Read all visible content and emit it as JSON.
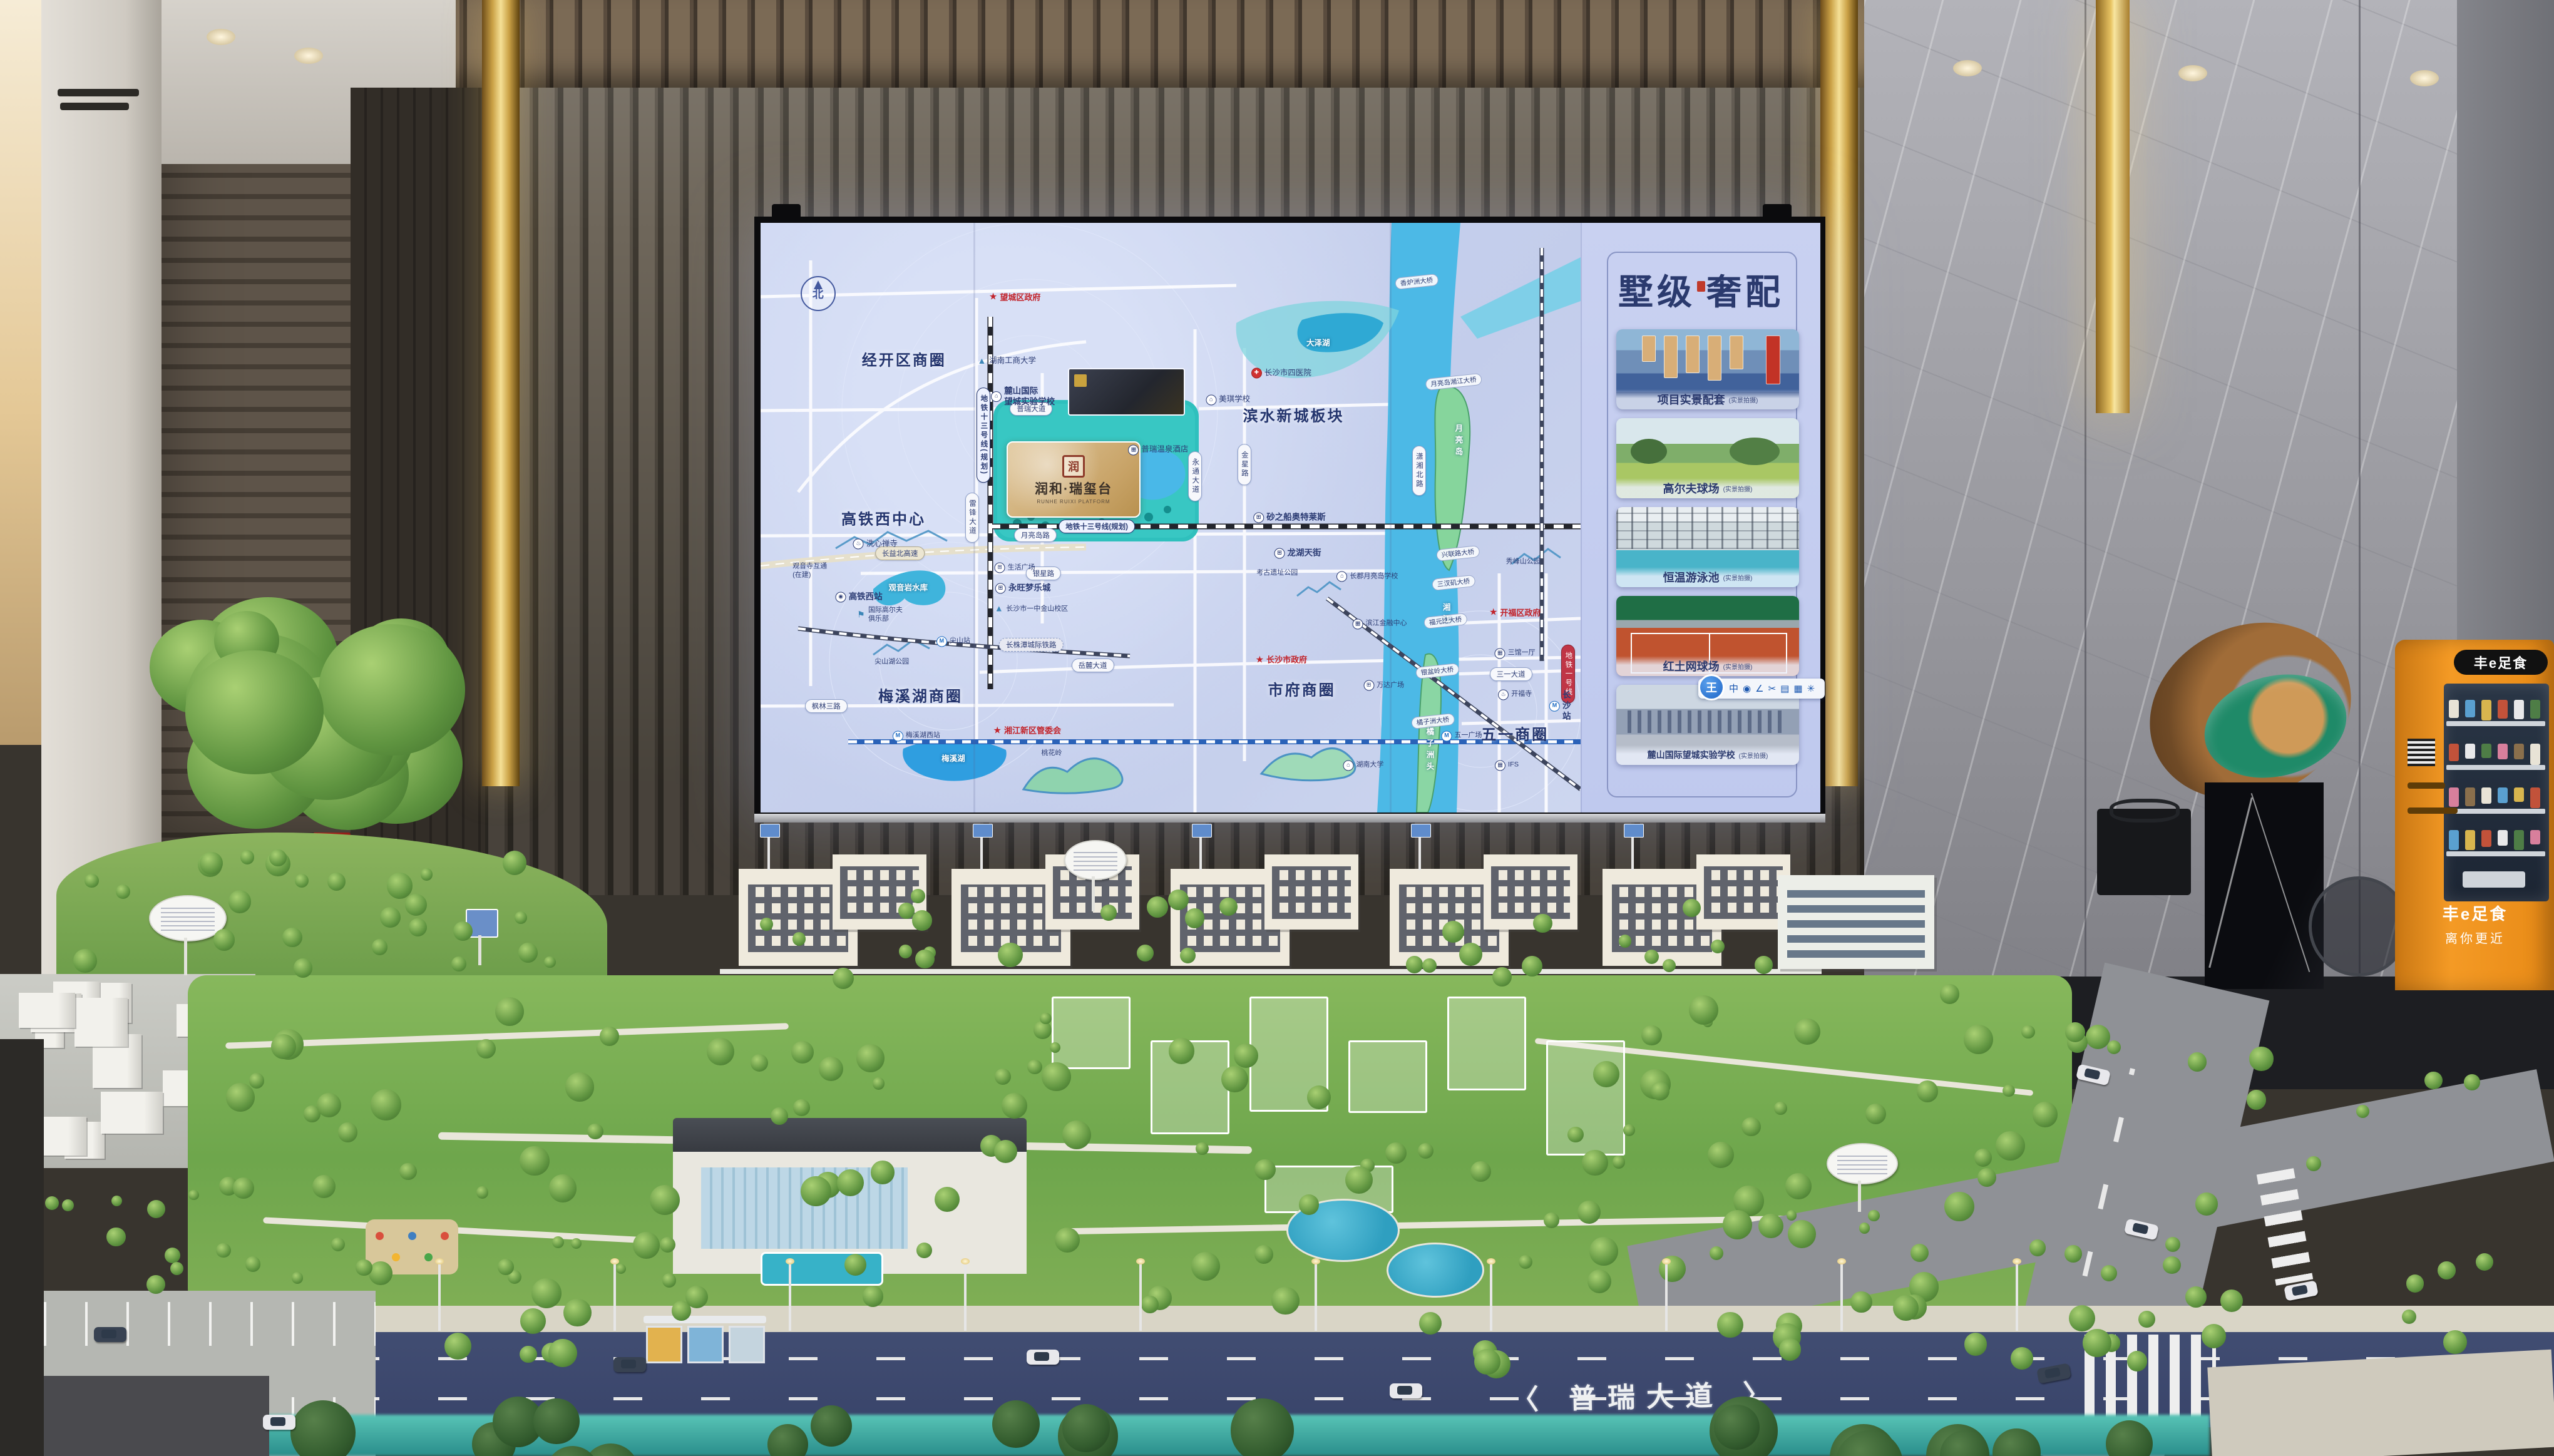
{
  "screen": {
    "map": {
      "compass": "北",
      "project": {
        "logo_char": "润",
        "name": "润和·瑞玺台",
        "name_en": "RUNHE RUIXI PLATFORM"
      },
      "area_labels": [
        {
          "text": "经开区商圈",
          "x": 17.5,
          "y": 23
        },
        {
          "text": "高铁西中心",
          "x": 15,
          "y": 50
        },
        {
          "text": "滨水新城板块",
          "x": 65,
          "y": 32.5
        },
        {
          "text": "梅溪湖商圈",
          "x": 19.5,
          "y": 80
        },
        {
          "text": "市府商圈",
          "x": 66,
          "y": 79
        },
        {
          "text": "五一商圈",
          "x": 92,
          "y": 86.5
        }
      ],
      "star_labels": [
        {
          "text": "望城区政府",
          "x": 31,
          "y": 12.5
        },
        {
          "text": "湘江新区管委会",
          "x": 32.5,
          "y": 86
        },
        {
          "text": "长沙市政府",
          "x": 63.5,
          "y": 74
        },
        {
          "text": "开福区政府",
          "x": 92,
          "y": 66
        }
      ],
      "road_labels": [
        {
          "text": "普瑞大道",
          "x": 33,
          "y": 31.5,
          "style": "road"
        },
        {
          "text": "月亮岛路",
          "x": 33.5,
          "y": 53,
          "style": "road"
        },
        {
          "text": "银星路",
          "x": 34.5,
          "y": 59.5,
          "style": "road"
        },
        {
          "text": "岳麓大道",
          "x": 40.5,
          "y": 75,
          "style": "road"
        },
        {
          "text": "枫林三路",
          "x": 8,
          "y": 82,
          "style": "road"
        },
        {
          "text": "三一大道",
          "x": 91.5,
          "y": 76.5,
          "style": "road"
        },
        {
          "text": "长益北高速",
          "x": 17,
          "y": 56,
          "style": "highway"
        },
        {
          "text": "长株潭城际铁路",
          "x": 33,
          "y": 71.5,
          "style": "rail"
        },
        {
          "text": "地铁十三号线(规划)",
          "x": 41,
          "y": 51.5,
          "style": "metro13"
        },
        {
          "text": "地铁十三号线(规划)",
          "x": 27.2,
          "y": 36,
          "style": "metro13",
          "vertical": true
        },
        {
          "text": "雷锋大道",
          "x": 25.8,
          "y": 50,
          "style": "road",
          "vertical": true
        },
        {
          "text": "永通大道",
          "x": 53,
          "y": 43,
          "style": "road",
          "vertical": true
        },
        {
          "text": "金星路",
          "x": 59,
          "y": 41,
          "style": "road",
          "vertical": true
        },
        {
          "text": "潇湘北路",
          "x": 80.3,
          "y": 42,
          "style": "road",
          "vertical": true
        },
        {
          "text": "地铁一号线",
          "x": 98.5,
          "y": 76.5,
          "style": "redline",
          "vertical": true
        }
      ],
      "bridge_labels": [
        {
          "text": "香炉洲大桥",
          "x": 80,
          "y": 10
        },
        {
          "text": "月亮岛湘江大桥",
          "x": 84.5,
          "y": 27
        },
        {
          "text": "兴联路大桥",
          "x": 85,
          "y": 56
        },
        {
          "text": "三汊矶大桥",
          "x": 84.5,
          "y": 61
        },
        {
          "text": "福元路大桥",
          "x": 83.5,
          "y": 67.5
        },
        {
          "text": "银盆岭大桥",
          "x": 82.5,
          "y": 76
        },
        {
          "text": "橘子洲大桥",
          "x": 82,
          "y": 84.5
        }
      ],
      "poi_labels": [
        {
          "text": "麓山国际\n望城实验学校",
          "x": 32,
          "y": 29.5,
          "icon": "school",
          "cls": "bold"
        },
        {
          "text": "湖南工商大学",
          "x": 30,
          "y": 23.5,
          "icon": "mountain"
        },
        {
          "text": "美琪学校",
          "x": 57,
          "y": 30,
          "icon": "school"
        },
        {
          "text": "普瑞温泉酒店",
          "x": 48.5,
          "y": 38.5,
          "icon": "building"
        },
        {
          "text": "长沙市四医院",
          "x": 63.5,
          "y": 25.5,
          "icon": "hospital"
        },
        {
          "text": "洗心禅寺",
          "x": 14,
          "y": 54.5,
          "icon": "temple"
        },
        {
          "text": "高铁西站",
          "x": 12,
          "y": 63.5,
          "icon": "train",
          "cls": "bold"
        },
        {
          "text": "观音岩水库",
          "x": 18,
          "y": 62,
          "cls": "white"
        },
        {
          "text": "观音寺互通\n(在建)",
          "x": 6,
          "y": 59,
          "cls": "small"
        },
        {
          "text": "国际高尔夫\n俱乐部",
          "x": 14.5,
          "y": 66.5,
          "icon": "golf",
          "cls": "small"
        },
        {
          "text": "尖山站",
          "x": 23.5,
          "y": 71,
          "icon": "metro",
          "cls": "small"
        },
        {
          "text": "尖山湖公园",
          "x": 16,
          "y": 74.5,
          "cls": "small"
        },
        {
          "text": "永旺梦乐城",
          "x": 32,
          "y": 62,
          "icon": "cart",
          "cls": "bold"
        },
        {
          "text": "生活广场",
          "x": 31,
          "y": 58.5,
          "icon": "cart",
          "cls": "small"
        },
        {
          "text": "长沙市一中金山校区",
          "x": 33,
          "y": 65.5,
          "icon": "mountain",
          "cls": "small"
        },
        {
          "text": "梅溪湖西站",
          "x": 19,
          "y": 87,
          "icon": "metro",
          "cls": "small"
        },
        {
          "text": "梅溪湖",
          "x": 23.5,
          "y": 91,
          "cls": "white"
        },
        {
          "text": "桃花岭",
          "x": 35.5,
          "y": 90,
          "cls": "small"
        },
        {
          "text": "砂之船奥特莱斯",
          "x": 64.5,
          "y": 50,
          "icon": "cart",
          "cls": "bold"
        },
        {
          "text": "龙湖天街",
          "x": 65.5,
          "y": 56,
          "icon": "cart",
          "cls": "bold"
        },
        {
          "text": "考古遗址公园",
          "x": 63,
          "y": 59.5,
          "cls": "small"
        },
        {
          "text": "长郡月亮岛学校",
          "x": 74,
          "y": 60,
          "icon": "school",
          "cls": "small"
        },
        {
          "text": "秀峰山公园",
          "x": 93,
          "y": 57.5,
          "cls": "small"
        },
        {
          "text": "滨江金融中心",
          "x": 75.5,
          "y": 68,
          "icon": "building",
          "cls": "small"
        },
        {
          "text": "万达广场",
          "x": 76,
          "y": 78.5,
          "icon": "cart",
          "cls": "small"
        },
        {
          "text": "湖南大学",
          "x": 73.5,
          "y": 92,
          "icon": "school",
          "cls": "small"
        },
        {
          "text": "三馆一厅",
          "x": 92,
          "y": 73,
          "icon": "building",
          "cls": "small"
        },
        {
          "text": "开福寺",
          "x": 92,
          "y": 80,
          "icon": "temple",
          "cls": "small"
        },
        {
          "text": "长沙站",
          "x": 97.5,
          "y": 82,
          "icon": "metro",
          "cls": "bold"
        },
        {
          "text": "五一广场",
          "x": 85.5,
          "y": 87,
          "icon": "metro",
          "cls": "small"
        },
        {
          "text": "IFS",
          "x": 91,
          "y": 92,
          "icon": "building",
          "cls": "small"
        },
        {
          "text": "大泽湖",
          "x": 68,
          "y": 20.5,
          "cls": "white"
        },
        {
          "text": "月亮岛",
          "x": 85,
          "y": 37,
          "cls": "white vert"
        },
        {
          "text": "湘江",
          "x": 83.5,
          "y": 66.5,
          "cls": "white vert"
        },
        {
          "text": "橘子洲头",
          "x": 81.5,
          "y": 89.5,
          "cls": "white vert"
        }
      ]
    },
    "panel": {
      "title_left": "墅级",
      "title_right": "奢配",
      "cards": [
        {
          "caption": "项目实景配套",
          "sub": "(实景拍摄)",
          "kind": "aerial"
        },
        {
          "caption": "高尔夫球场",
          "sub": "(实景拍摄)",
          "kind": "golf"
        },
        {
          "caption": "恒温游泳池",
          "sub": "(实景拍摄)",
          "kind": "pool"
        },
        {
          "caption": "红土网球场",
          "sub": "(实景拍摄)",
          "kind": "tennis"
        },
        {
          "caption": "麓山国际望城实验学校",
          "sub": "(实景拍摄)",
          "kind": "school"
        }
      ]
    },
    "toolbar": {
      "logo": "王",
      "icons": [
        {
          "name": "pointer-icon",
          "glyph": "中"
        },
        {
          "name": "laser-icon",
          "glyph": "◉"
        },
        {
          "name": "pen-icon",
          "glyph": "∠"
        },
        {
          "name": "scissors-icon",
          "glyph": "✂"
        },
        {
          "name": "whiteboard-icon",
          "glyph": "▤"
        },
        {
          "name": "theme-icon",
          "glyph": "▦"
        },
        {
          "name": "settings-icon",
          "glyph": "✳"
        }
      ]
    }
  },
  "model": {
    "road_sign": "〈 普瑞大道 〉"
  },
  "vending": {
    "brand": "丰e足食",
    "slogan": "离你更近"
  },
  "colors": {
    "accent_gold": "#e8c86a",
    "map_navy": "#24356e",
    "river_blue": "#4cb9e6",
    "park_teal": "#2fc0bd",
    "vending_orange": "#f49a25"
  }
}
